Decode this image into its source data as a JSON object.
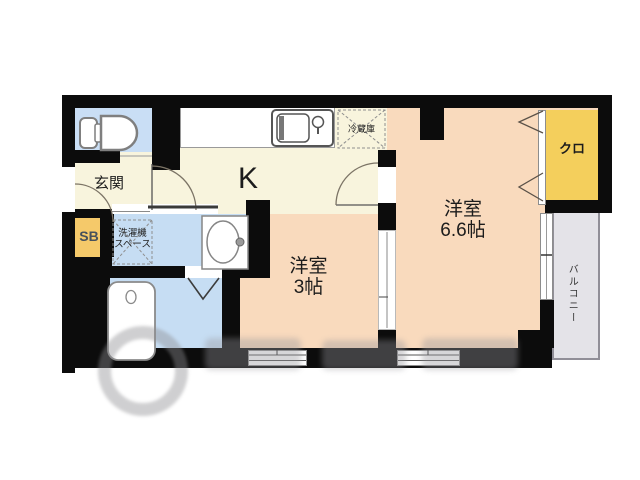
{
  "plan": {
    "type": "japanese-apartment-floorplan",
    "labels": {
      "kitchen": "K",
      "entrance": "玄関",
      "shoe_box": "SB",
      "fridge_space": "冷蔵庫",
      "washer_line1": "洗濯機",
      "washer_line2": "スペース",
      "room_main_name": "洋室",
      "room_main_size": "6.6帖",
      "room_small_name": "洋室",
      "room_small_size": "3帖",
      "closet": "クロ",
      "balcony": "バルコニー"
    },
    "colors": {
      "wall": "#0c0c0c",
      "kitchen_floor": "#f8f4dd",
      "room_floor": "#f9dabd",
      "wet_area_floor": "#c6ddf3",
      "toilet_floor": "#c9def5",
      "closet": "#f4cf5c",
      "shoe_box": "#f5c96a",
      "balcony": "#e4e3e8"
    },
    "icons": [
      "toilet-icon",
      "kitchen-sink-icon",
      "fridge-space-icon",
      "washer-space-icon",
      "vanity-icon",
      "bathtub-icon",
      "door-swing-icon",
      "folding-door-icon",
      "closet-chevron-icon",
      "sliding-window-icon",
      "watermark-logo"
    ]
  }
}
